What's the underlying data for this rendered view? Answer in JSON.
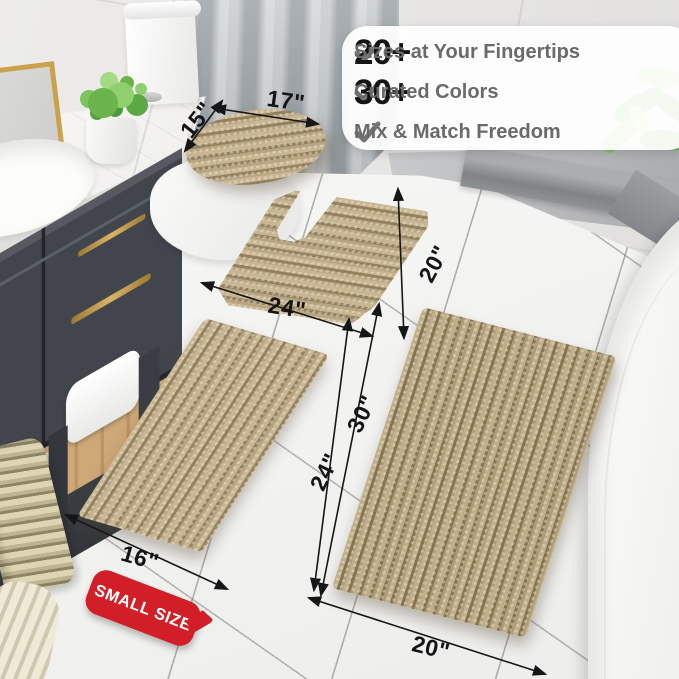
{
  "features": {
    "check": "✓",
    "items": [
      {
        "num": "20+",
        "label": "Sizes at Your Fingertips"
      },
      {
        "num": "30+",
        "label": "Curated Colors"
      },
      {
        "num": "",
        "label": "Mix & Match Freedom"
      }
    ]
  },
  "dims": {
    "lid_width": "17\"",
    "lid_depth": "15\"",
    "contour_width": "24\"",
    "contour_depth": "20\"",
    "small_length": "24\"",
    "small_width": "16\"",
    "large_length": "30\"",
    "large_width": "20\""
  },
  "badge": {
    "label": "SMALL SIZE"
  },
  "colors": {
    "badge_red": "#d21e27",
    "rug_beige": "#c4b290",
    "rug_dark": "#8f7d5b",
    "accent_gold": "#c9a24a",
    "check_gray": "#757575",
    "feature_text_gray": "#6a6a6a",
    "label_black": "#141414"
  }
}
